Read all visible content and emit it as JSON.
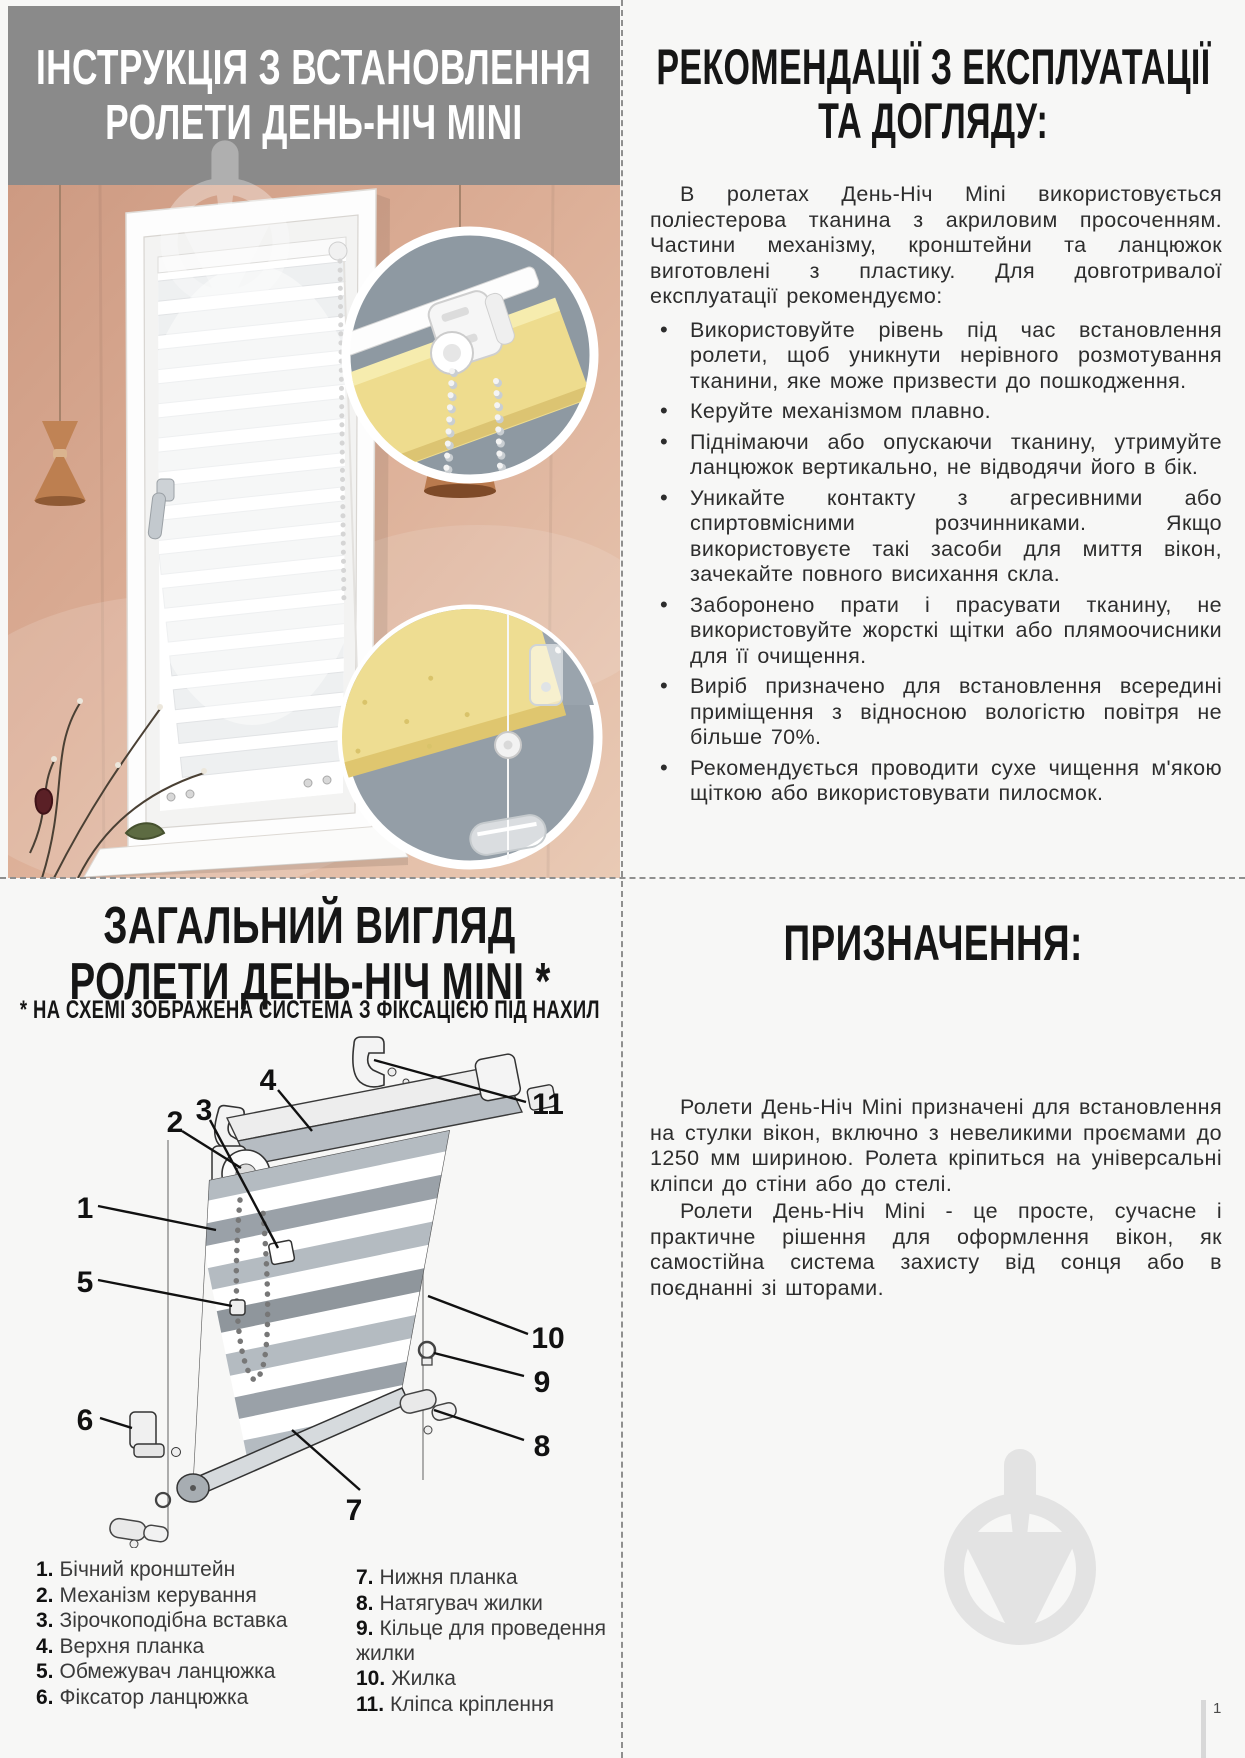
{
  "colors": {
    "header_bg": "#8a8a8a",
    "wall_peach": "#d7a48c",
    "inset_circle_bg": "#8e99a2",
    "fabric_yellow": "#eedc8e",
    "watermark_gray": "#e3e3e3",
    "text_black": "#161616"
  },
  "icons": {
    "watermark": "trowel-in-circle-logo"
  },
  "header": {
    "line1": "ІНСТРУКЦІЯ З ВСТАНОВЛЕННЯ",
    "line2": "РОЛЕТИ ДЕНЬ-НІЧ MINI"
  },
  "recommendations": {
    "title_line1": "РЕКОМЕНДАЦІЇ З ЕКСПЛУАТАЦІЇ",
    "title_line2": "ТА ДОГЛЯДУ:",
    "intro": "В ролетах День-Ніч Mini використовується поліестерова тканина з акриловим просоченням. Частини механізму, кронштейни та ланцюжок виготовлені з пластику. Для довготривалої експлуатації рекомендуємо:",
    "bullets": [
      "Використовуйте рівень під час встановлення ролети, щоб уникнути нерівного розмотування тканини, яке може призвести до пошкодження.",
      "Керуйте механізмом плавно.",
      "Піднімаючи або опускаючи тканину, утримуйте ланцюжок вертикально, не відводячи його в бік.",
      "Уникайте контакту з агресивними або спиртовмісними розчинниками. Якщо використовуєте такі засоби для миття вікон, зачекайте повного висихання скла.",
      "Заборонено прати і прасувати тканину, не використовуйте жорсткі щітки або плямоочисники для її очищення.",
      "Виріб призначено для встановлення всередині приміщення з відносною вологістю повітря не більше 70%.",
      "Рекомендується проводити сухе чищення м'якою щіткою або використовувати пилосмок."
    ]
  },
  "overview": {
    "title_line1": "ЗАГАЛЬНИЙ ВИГЛЯД",
    "title_line2": "РОЛЕТИ ДЕНЬ-НІЧ MINI *",
    "subtitle": "* НА СХЕМІ ЗОБРАЖЕНА СИСТЕМА З ФІКСАЦІЄЮ ПІД НАХИЛ",
    "diagram_numbers": [
      "1",
      "2",
      "3",
      "4",
      "5",
      "6",
      "7",
      "8",
      "9",
      "10",
      "11"
    ],
    "legend_col1": [
      {
        "num": "1.",
        "label": "Бічний кронштейн"
      },
      {
        "num": "2.",
        "label": "Механізм керування"
      },
      {
        "num": "3.",
        "label": "Зірочкоподібна вставка"
      },
      {
        "num": "4.",
        "label": "Верхня планка"
      },
      {
        "num": "5.",
        "label": "Обмежувач ланцюжка"
      },
      {
        "num": "6.",
        "label": "Фіксатор ланцюжка"
      }
    ],
    "legend_col2": [
      {
        "num": "7.",
        "label": "Нижня планка"
      },
      {
        "num": "8.",
        "label": "Натягувач жилки"
      },
      {
        "num": "9.",
        "label": "Кільце для проведення жилки"
      },
      {
        "num": "10.",
        "label": "Жилка"
      },
      {
        "num": "11.",
        "label": "Кліпса кріплення"
      }
    ]
  },
  "purpose": {
    "title": "ПРИЗНАЧЕННЯ:",
    "para1": "Ролети День-Ніч Mini призначені для встановлення на стулки вікон, включно з невеликими проємами до 1250 мм шириною. Ролета кріпиться на універсальні кліпси до стіни або до стелі.",
    "para2": "Ролети День-Ніч Mini - це просте, сучасне і практичне рішення для оформлення вікон, як самостійна система захисту від сонця або в поєднанні зі шторами."
  },
  "footer": {
    "page_number": "1"
  }
}
